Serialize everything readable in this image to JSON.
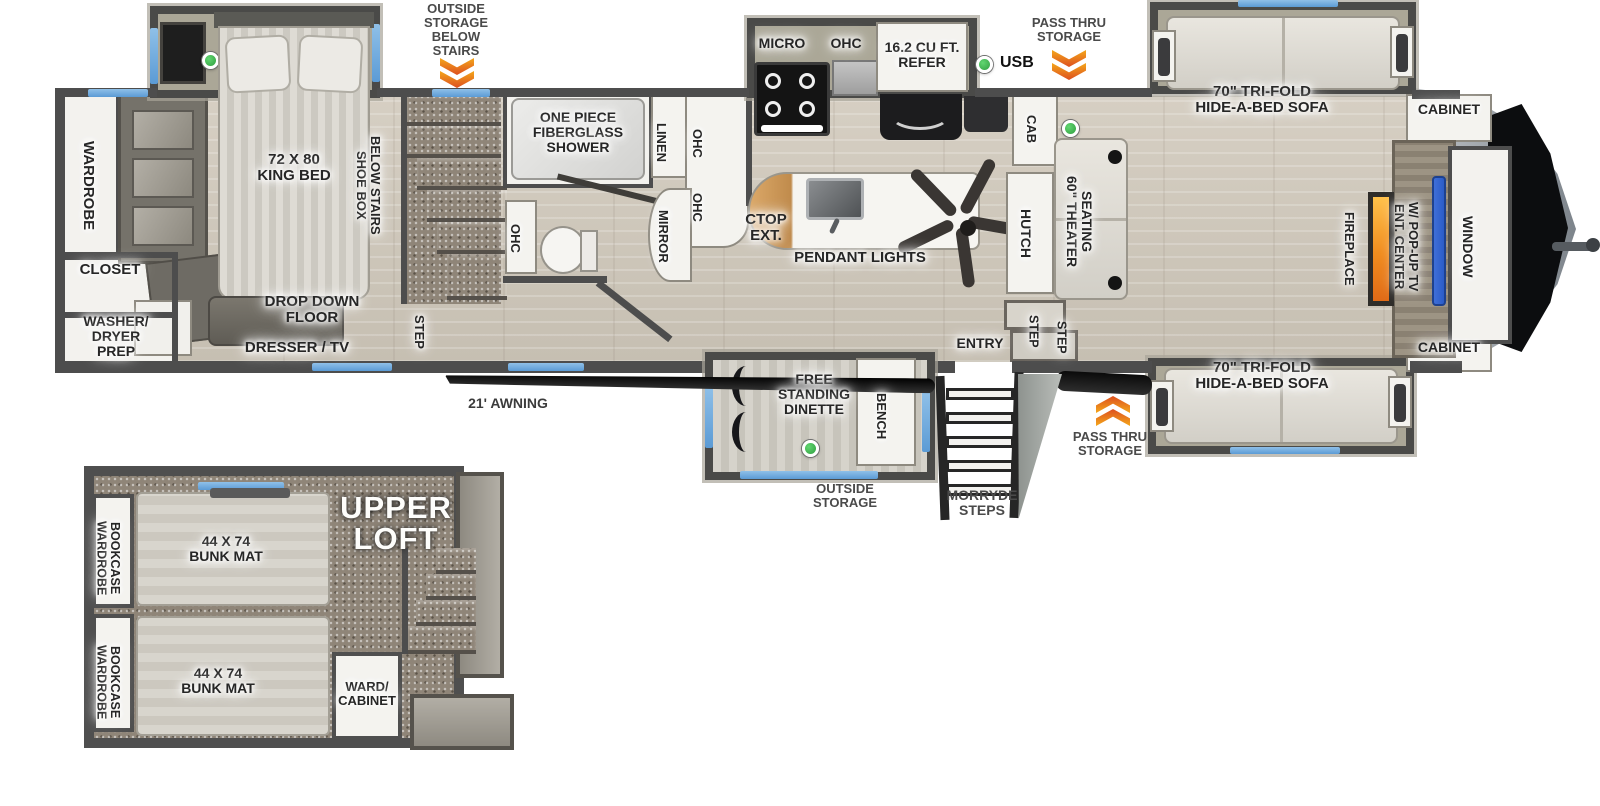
{
  "colors": {
    "wall": "#4d4d4d",
    "accent_blue": "#5b9bd5",
    "arrow_orange": "#e8762a",
    "led_green": "#2f9e3f",
    "fireplace_orange": "#f08c1e",
    "tv_blue": "#2b5cc8"
  },
  "exterior": {
    "outside_storage_below_stairs": "OUTSIDE\nSTORAGE\nBELOW\nSTAIRS",
    "pass_thru_top": "PASS THRU\nSTORAGE",
    "pass_thru_bottom": "PASS THRU\nSTORAGE",
    "usb": "USB",
    "awning": "21' AWNING",
    "morryde_steps": "MORRYDE\nSTEPS",
    "outside_storage_dinette": "OUTSIDE\nSTORAGE"
  },
  "bedroom": {
    "wardrobe": "WARDROBE",
    "closet": "CLOSET",
    "washer_dryer": "WASHER/\nDRYER\nPREP",
    "king_bed": "72 X 80\nKING BED",
    "shoe_box": "SHOE BOX\nBELOW STAIRS",
    "drop_down_floor": "DROP DOWN FLOOR",
    "dresser_tv": "DRESSER / TV",
    "step": "STEP"
  },
  "bathroom": {
    "shower": "ONE PIECE\nFIBERGLASS\nSHOWER",
    "linen": "LINEN",
    "ohc_upper": "OHC",
    "ohc_lower": "OHC",
    "ohc_toilet": "OHC",
    "mirror": "MIRROR"
  },
  "kitchen": {
    "micro": "MICRO",
    "ohc": "OHC",
    "refer": "16.2 CU FT.\nREFER",
    "ctop_ext": "CTOP\nEXT.",
    "pendant_lights": "PENDANT LIGHTS"
  },
  "living": {
    "cab": "CAB",
    "hutch": "HUTCH",
    "theater_seating": "60\" THEATER\nSEATING",
    "sofa_top": "70\" TRI-FOLD\nHIDE-A-BED SOFA",
    "sofa_bottom": "70\" TRI-FOLD\nHIDE-A-BED SOFA",
    "fireplace": "FIREPLACE",
    "ent_center": "ENT. CENTER\nW/ POP-UP TV",
    "window": "WINDOW",
    "cabinet_top": "CABINET",
    "cabinet_bottom": "CABINET",
    "entry": "ENTRY",
    "step_1": "STEP",
    "step_2": "STEP"
  },
  "dinette": {
    "free_standing": "FREE\nSTANDING\nDINETTE",
    "bench": "BENCH"
  },
  "loft": {
    "title": "UPPER\nLOFT",
    "wardrobe_bookcase_1": "WARDROBE\nBOOKCASE",
    "wardrobe_bookcase_2": "WARDROBE\nBOOKCASE",
    "bunk_1": "44 X 74\nBUNK MAT",
    "bunk_2": "44 X 74\nBUNK MAT",
    "ward_cabinet": "WARD/\nCABINET"
  }
}
